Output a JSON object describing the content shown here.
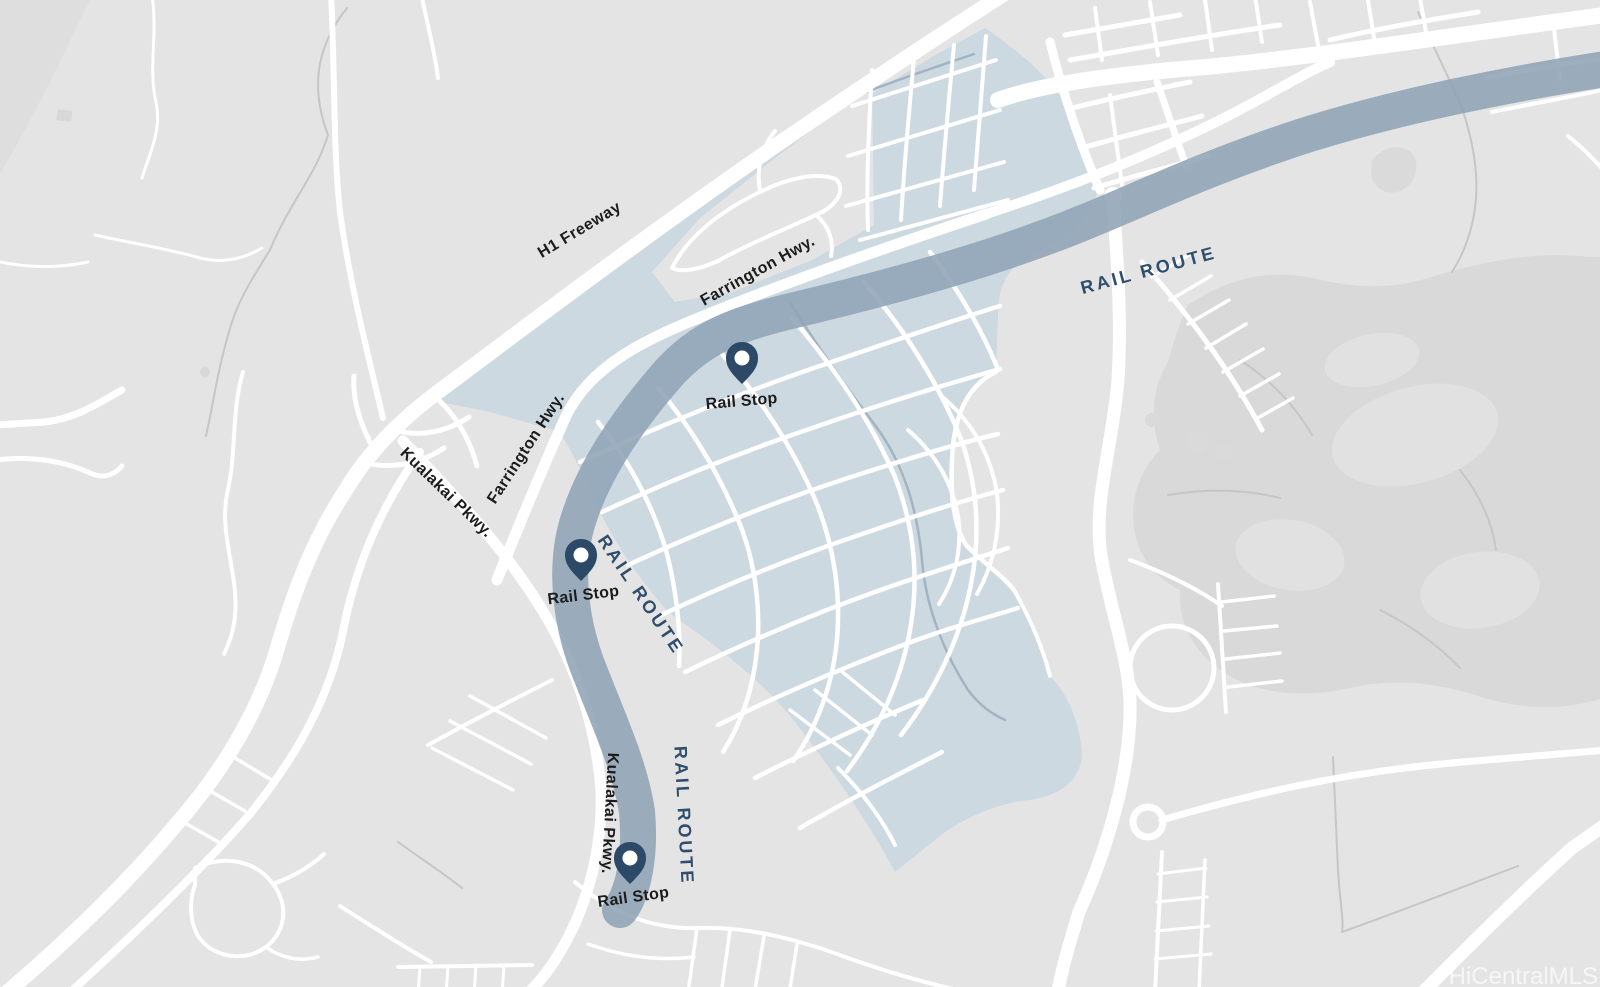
{
  "map": {
    "watermark": "HiCentralMLS",
    "colors": {
      "background": "#e4e4e4",
      "terrain_blob": "#d9d9d9",
      "development_area": "#cdd9e1",
      "rail_route_band": "#8fa4b6",
      "rail_stop_pin": "#2c4a67",
      "road": "#ffffff",
      "route_label_text": "#2f4e6d",
      "road_label_text": "#1c1c1c"
    },
    "road_labels": [
      {
        "id": "h1-freeway",
        "text": "H1 Freeway"
      },
      {
        "id": "farrington-hwy-upper",
        "text": "Farrington Hwy."
      },
      {
        "id": "farrington-hwy-lower",
        "text": "Farrington Hwy."
      },
      {
        "id": "kualakai-pkwy-upper",
        "text": "Kualakai Pkwy."
      },
      {
        "id": "kualakai-pkwy-lower",
        "text": "Kualakai Pkwy."
      }
    ],
    "route_labels": [
      {
        "id": "rail-route-northeast",
        "text": "RAIL ROUTE"
      },
      {
        "id": "rail-route-middle",
        "text": "RAIL ROUTE"
      },
      {
        "id": "rail-route-south",
        "text": "RAIL ROUTE"
      }
    ],
    "stops": [
      {
        "label": "Rail Stop"
      },
      {
        "label": "Rail Stop"
      },
      {
        "label": "Rail Stop"
      }
    ]
  }
}
